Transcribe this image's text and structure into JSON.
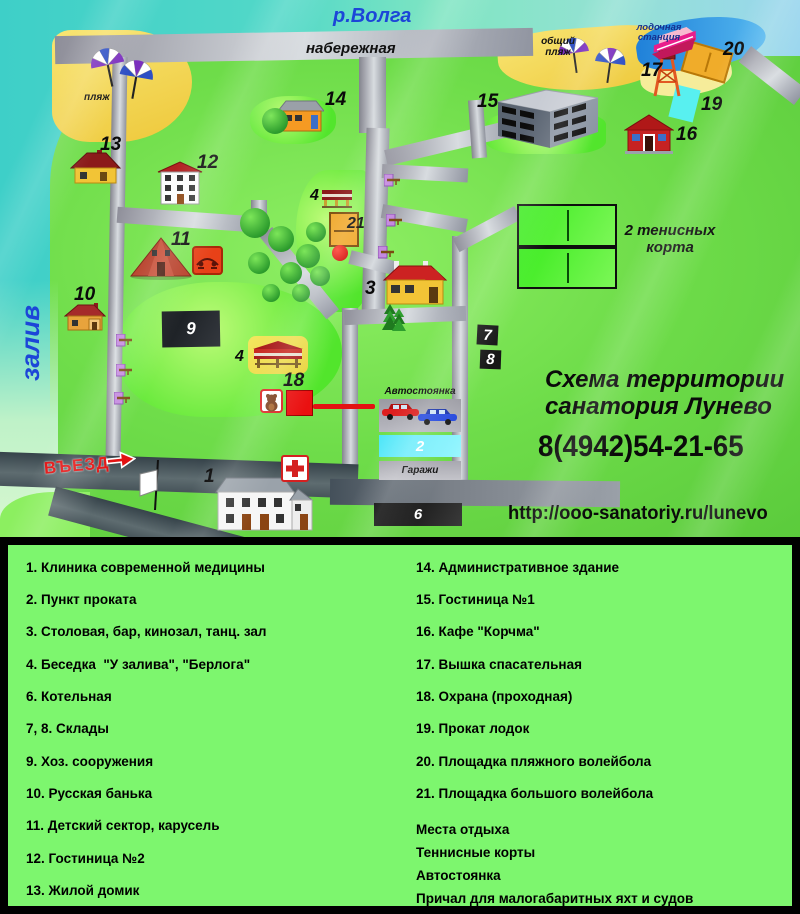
{
  "map": {
    "river": "р.Волга",
    "embankment": "набережная",
    "bay": "залив",
    "beach": "пляж",
    "public_beach_l1": "общий",
    "public_beach_l2": "пляж",
    "boat_station_l1": "лодочная",
    "boat_station_l2": "станция",
    "entrance": "ВЪЕЗД",
    "tennis_l1": "2 тенисных",
    "tennis_l2": "корта",
    "parking": "Автостоянка",
    "garages": "Гаражи",
    "markers": {
      "m1": "1",
      "m2": "2",
      "m3": "3",
      "m4": "4",
      "m6": "6",
      "m7": "7",
      "m8": "8",
      "m9": "9",
      "m10": "10",
      "m11": "11",
      "m12": "12",
      "m13": "13",
      "m14": "14",
      "m15": "15",
      "m16": "16",
      "m17": "17",
      "m18": "18",
      "m19": "19",
      "m20": "20",
      "m21": "21"
    }
  },
  "info": {
    "title_l1": "Схема территории",
    "title_l2": "санатория Лунево",
    "phone": "8(4942)54-21-65",
    "url": "http://ooo-sanatoriy.ru/lunevo"
  },
  "legend": {
    "left": [
      "1. Клиника современной медицины",
      "2. Пункт проката",
      "3. Столовая, бар, кинозал, танц. зал",
      "4. Беседка  \"У залива\", \"Берлога\"",
      "6. Котельная",
      "7, 8. Склады",
      "9. Хоз. сооружения",
      "10. Русская банька",
      "11. Детский сектор, карусель",
      "12. Гостиница №2",
      "13. Жилой домик"
    ],
    "right": [
      "14. Административное здание",
      "15. Гостиница №1",
      "16. Кафе \"Корчма\"",
      "17. Вышка спасательная",
      "18. Охрана (проходная)",
      "19. Прокат лодок",
      "20. Площадка пляжного волейбола",
      "21. Площадка большого волейбола"
    ],
    "extras": [
      "Места отдыха",
      "Теннисные корты",
      "Автостоянка",
      "Причал для малогабаритных яхт и судов"
    ]
  },
  "colors": {
    "water": "#3ECFC8",
    "land": "#6FDD4A",
    "road": "#9A9AA2",
    "beach": "#F2CE4E",
    "legend_bg": "#7DF66E",
    "text_blue": "#1C46D8",
    "accent_red": "#E31212",
    "court_orange": "#F0A82A",
    "court_cyan": "#55E8F8",
    "court_green": "#3BEB1F"
  }
}
